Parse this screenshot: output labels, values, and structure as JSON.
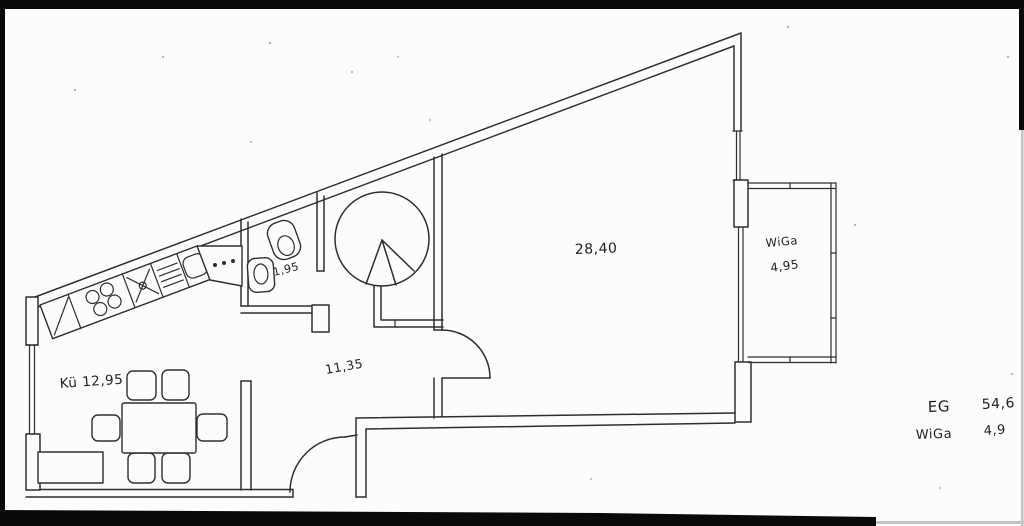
{
  "document": {
    "kind": "scanned hand-drawn floor plan",
    "paper_color": "#fcfcfb",
    "ink_color": "#2e2e2e",
    "frame_color": "#0a0a0a"
  },
  "rooms": {
    "kitchen": {
      "label": "Kü 12,95"
    },
    "wc": {
      "area": "1,95"
    },
    "hall": {
      "area": "11,35"
    },
    "living": {
      "area": "28,40"
    },
    "wintergarden": {
      "name": "WiGa",
      "area": "4,95"
    }
  },
  "legend": {
    "rows": [
      {
        "label": "EG",
        "value": "54,6"
      },
      {
        "label": "WiGa",
        "value": "4,9"
      }
    ]
  }
}
